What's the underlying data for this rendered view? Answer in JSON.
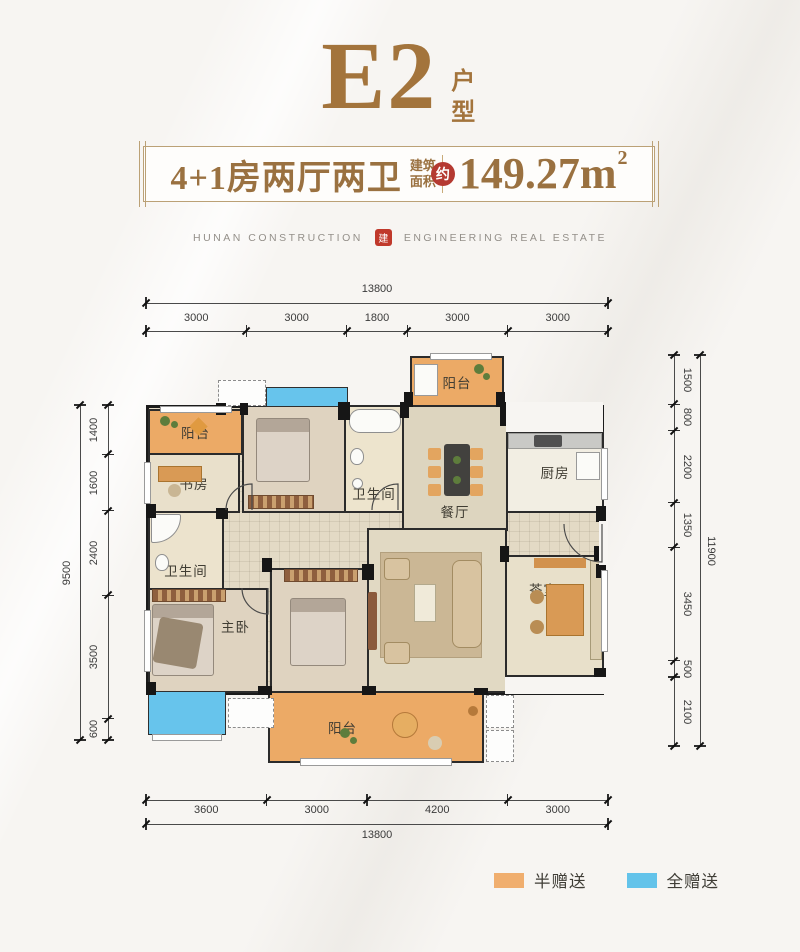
{
  "header": {
    "title": "E2",
    "title_suffix": "户型",
    "banner": {
      "layout_text": "4+1房两厅两卫",
      "area_label_line1": "建筑",
      "area_label_line2": "面积",
      "approx_badge": "约",
      "area_value": "149.27m",
      "area_superscript": "2"
    },
    "logo_left": "HUNAN CONSTRUCTION",
    "logo_seal": "建",
    "logo_right": "ENGINEERING REAL ESTATE"
  },
  "plan": {
    "rooms": [
      {
        "id": "balcony-top",
        "label": "阳台"
      },
      {
        "id": "balcony-left",
        "label": "阳台"
      },
      {
        "id": "study",
        "label": "书房"
      },
      {
        "id": "bedroom-top",
        "label": "卧室"
      },
      {
        "id": "bathroom-mid",
        "label": "卫生间"
      },
      {
        "id": "dining",
        "label": "餐厅"
      },
      {
        "id": "kitchen",
        "label": "厨房"
      },
      {
        "id": "bathroom-left",
        "label": "卫生间"
      },
      {
        "id": "master-bedroom",
        "label": "主卧"
      },
      {
        "id": "bedroom-bottom",
        "label": "卧室"
      },
      {
        "id": "living",
        "label": "客厅"
      },
      {
        "id": "tea-room",
        "label": "茶室"
      },
      {
        "id": "balcony-bottom",
        "label": "阳台"
      }
    ]
  },
  "dimensions": {
    "top": {
      "total": "13800",
      "segments": [
        "3000",
        "3000",
        "1800",
        "3000",
        "3000"
      ]
    },
    "bottom": {
      "total": "13800",
      "segments": [
        "3600",
        "3000",
        "4200",
        "3000"
      ]
    },
    "left": {
      "total": "9500",
      "segments": [
        "1400",
        "1600",
        "2400",
        "3500",
        "600"
      ]
    },
    "right": {
      "total": "11900",
      "segments": [
        "1500",
        "800",
        "2200",
        "1350",
        "3450",
        "500",
        "2100"
      ]
    }
  },
  "legend": {
    "items": [
      {
        "label": "半赠送",
        "color": "#f0ae6e"
      },
      {
        "label": "全赠送",
        "color": "#63c3ea"
      }
    ]
  },
  "colors": {
    "accent_brown": "#a3743c",
    "approx_red": "#b53a31",
    "seal_red": "#c0392b",
    "half_gift": "#f0ae6e",
    "full_gift": "#63c3ea"
  }
}
